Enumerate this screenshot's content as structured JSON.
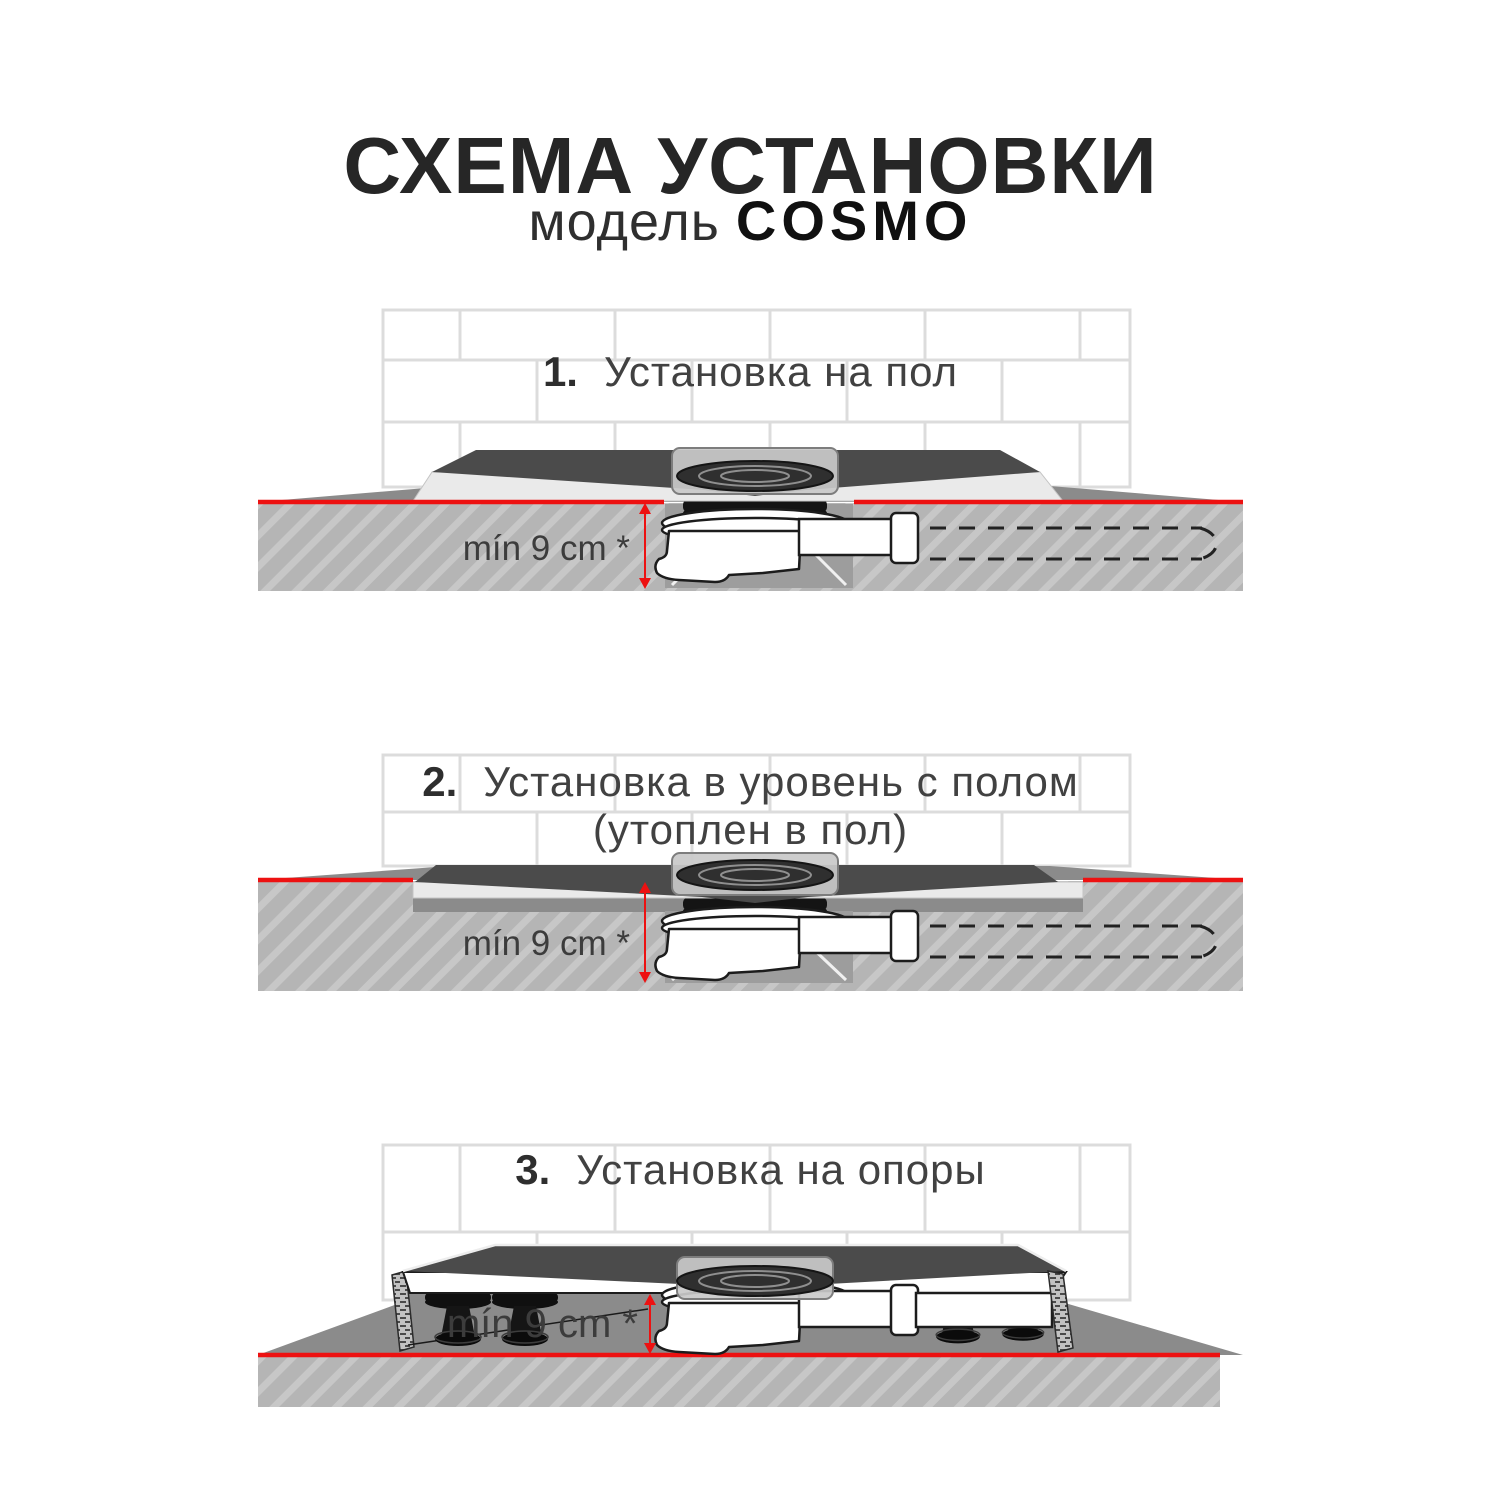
{
  "header": {
    "title": "СХЕМА УСТАНОВКИ",
    "model_label": "модель",
    "model_name": "COSMO"
  },
  "sections": [
    {
      "number": "1.",
      "title": "Установка на пол",
      "dimension_label": "mín 9 cm *"
    },
    {
      "number": "2.",
      "title": "Установка в уровень с полом",
      "title_line2": "(утоплен в пол)",
      "dimension_label": "mín 9 cm *"
    },
    {
      "number": "3.",
      "title": "Установка на опоры",
      "dimension_label": "mín 9 cm *"
    }
  ],
  "colors": {
    "floor_level_red": "#ed1111",
    "tray_surface": "#4b4b4b",
    "floor_surface": "#8b8b8b",
    "screed_hatch": "#b5b5b5",
    "tile_grout": "#dcdcdc"
  }
}
